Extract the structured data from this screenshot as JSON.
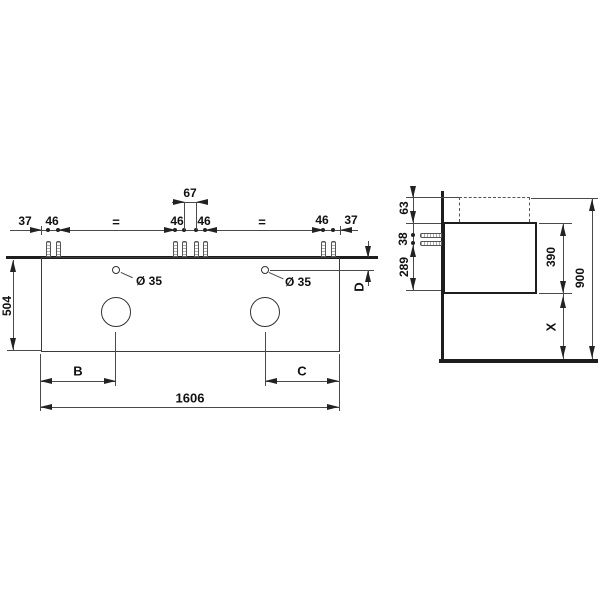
{
  "front_view": {
    "top_dimensions": {
      "d37_left": "37",
      "d46_left": "46",
      "eq_left": "=",
      "d67": "67",
      "d46_mid_left": "46",
      "d46_mid_right": "46",
      "eq_right": "=",
      "d46_right": "46",
      "d37_right": "37"
    },
    "hole_left": "Ø 35",
    "hole_right": "Ø 35",
    "depth": "504",
    "b": "B",
    "c": "C",
    "d": "D",
    "width": "1606"
  },
  "side_view": {
    "d63": "63",
    "d38": "38",
    "d289": "289",
    "d390": "390",
    "x": "X",
    "d900": "900"
  },
  "colors": {
    "ink": "#1d1d1d",
    "thin_line": "#4a4a4a",
    "background": "#ffffff"
  }
}
